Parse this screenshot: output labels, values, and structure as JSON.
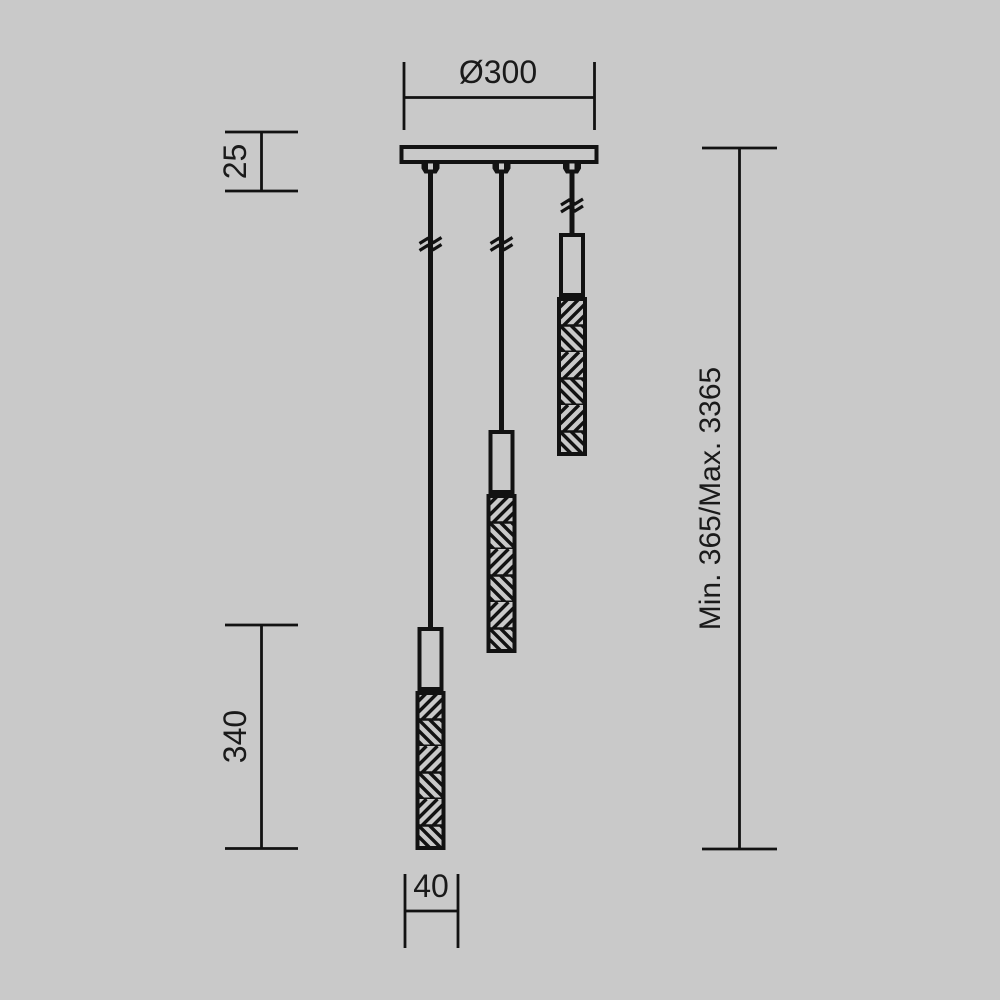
{
  "page": {
    "background_color": "#c9c9c9",
    "line_color": "#121212",
    "text_color": "#1a1a1a"
  },
  "drawing": {
    "description": "Technical dimension drawing of a three-light pendant chandelier with round ceiling canopy and textured cylindrical shades",
    "pendant_count": 3,
    "labels": {
      "canopy_diameter": "Ø300",
      "canopy_height": "25",
      "pendant_length": "340",
      "pendant_diameter": "40",
      "suspension_height": "Min. 365/Max. 3365"
    }
  }
}
